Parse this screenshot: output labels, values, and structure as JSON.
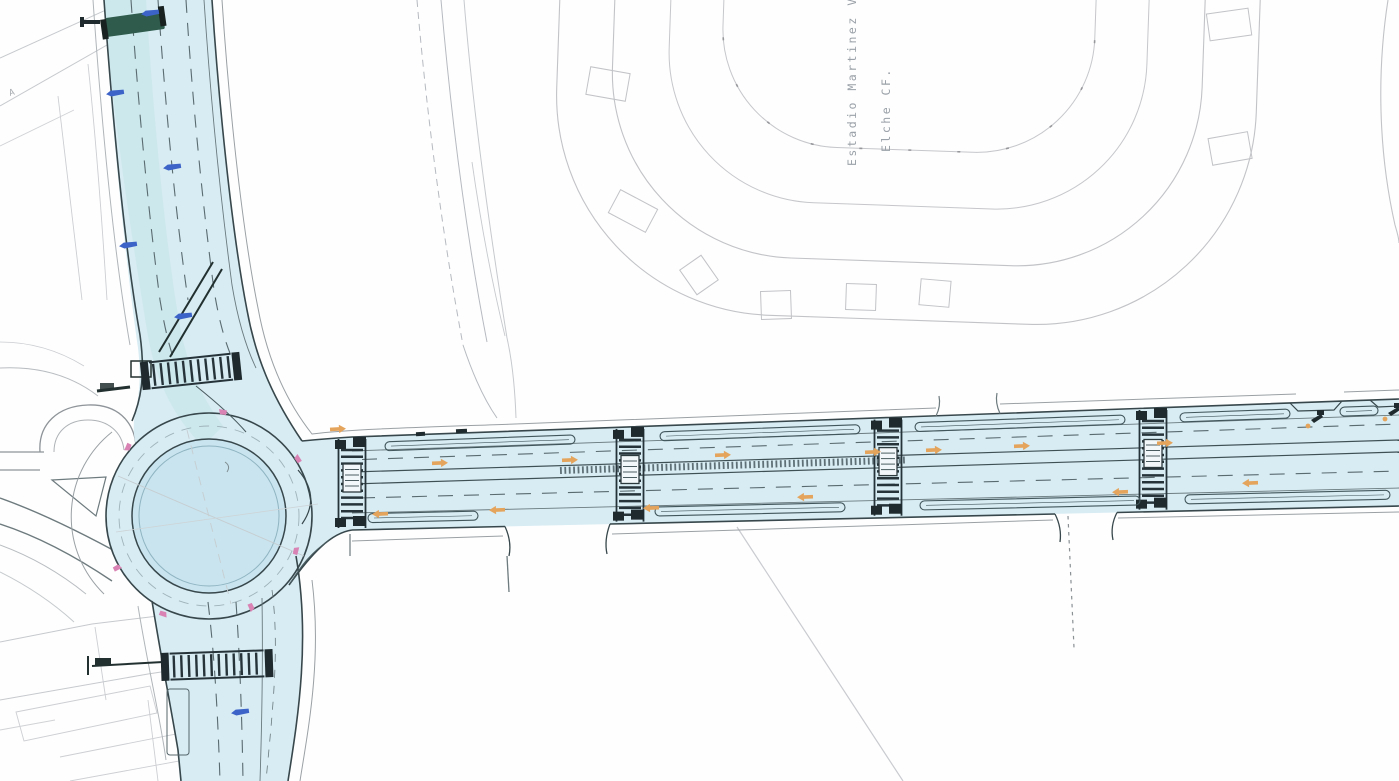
{
  "labels": {
    "stadium_line1": "Estadio Martinez V",
    "stadium_line2": "Elche CF.",
    "corner_street": "A"
  },
  "colors": {
    "road_fill": "#d7ecf3",
    "island_fill": "#c9e4ee",
    "casing": "#37474b",
    "lane_line": "#5a6b70",
    "zebra": "#26343a",
    "zebra_block": "#1e2a2d",
    "bay_line": "#41565b",
    "faint": "#c6c9cd",
    "mid_gray": "#9aa0a4",
    "stadium_line": "#c2c3c7",
    "green_crossing": "#2e5b4c",
    "pink_marker": "#d983b4",
    "orange_marker": "#e5a45c",
    "blue_marker": "#3c63c8",
    "label_gray": "#9aa1a8"
  },
  "map": {
    "pedestrian_crossings": [
      {
        "x": 352
      },
      {
        "x": 630
      },
      {
        "x": 888
      },
      {
        "x": 1153
      }
    ],
    "arm_crossings": [
      {
        "axis": "north",
        "x1": 150,
        "x2": 232,
        "y": 371,
        "tilt": -6
      },
      {
        "axis": "south",
        "x1": 170,
        "x2": 264,
        "y": 665,
        "tilt": -2
      }
    ],
    "parking_bays": {
      "top": [
        [
          385,
          575
        ],
        [
          660,
          860
        ],
        [
          915,
          1125
        ],
        [
          1180,
          1290
        ],
        [
          1340,
          1378
        ]
      ],
      "bottom": [
        [
          368,
          478
        ],
        [
          655,
          845
        ],
        [
          920,
          1140
        ],
        [
          1185,
          1390
        ]
      ]
    },
    "markers": {
      "direction_arrows": [
        [
          338,
          429,
          -3
        ],
        [
          440,
          463,
          -2
        ],
        [
          570,
          460,
          -2
        ],
        [
          723,
          455,
          -2
        ],
        [
          873,
          452,
          -2
        ],
        [
          934,
          450,
          -2
        ],
        [
          1022,
          446,
          -2
        ],
        [
          1165,
          443,
          -2
        ],
        [
          380,
          514,
          178
        ],
        [
          497,
          510,
          178
        ],
        [
          651,
          508,
          178
        ],
        [
          805,
          497,
          178
        ],
        [
          1120,
          492,
          178
        ],
        [
          1250,
          483,
          178
        ]
      ],
      "pink_points": [
        [
          223,
          412
        ],
        [
          298,
          459
        ],
        [
          296,
          551
        ],
        [
          117,
          568
        ],
        [
          163,
          614
        ],
        [
          251,
          607
        ],
        [
          128,
          447
        ]
      ],
      "blue_points": [
        [
          150,
          13
        ],
        [
          115,
          93
        ],
        [
          172,
          167
        ],
        [
          128,
          245
        ],
        [
          183,
          316
        ],
        [
          240,
          712
        ]
      ],
      "sign_posts": [
        [
          1311,
          420
        ],
        [
          1388,
          413
        ]
      ]
    }
  }
}
